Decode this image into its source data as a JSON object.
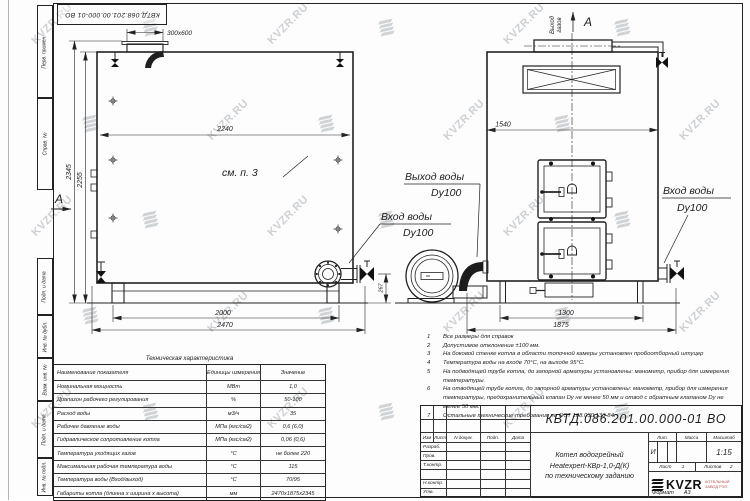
{
  "doc": {
    "number": "КВТД.086.201.00.000-01 ВО",
    "number_top": "КВТД.068.201.00.000-01 ВО",
    "format_label": "Формат",
    "format_value": "А3"
  },
  "watermark": {
    "text": "KVZR.RU"
  },
  "frame_stamps": {
    "top": [
      "Перв. примен.",
      "Справ. №"
    ],
    "bottom": [
      "Подп. и дата",
      "Инв. № дубл.",
      "Взам. инв. №",
      "Подп. и дата",
      "Инв. № подл."
    ]
  },
  "views": {
    "side": {
      "hatch_label": "300x600",
      "width_dim": "2240",
      "height_dim": "2345",
      "height_dim2": "2255",
      "see_note": "см. п. 3",
      "section_label": "А",
      "base_dim": "2000",
      "length_dim": "2470",
      "pipe_height_dim": "267"
    },
    "front": {
      "view_label": "А",
      "gas_outlet": [
        "Выход",
        "газов"
      ],
      "width_dim": "1540",
      "base_dim": "1300",
      "overall_dim": "1875"
    },
    "labels": {
      "water_outlet": [
        "Выход воды",
        "Dy100"
      ],
      "water_inlet_left": [
        "Вход воды",
        "Dy100"
      ],
      "water_inlet_right": [
        "Вход воды",
        "Dy100"
      ]
    }
  },
  "notes": [
    {
      "num": "1",
      "text": "Все размеры для справок"
    },
    {
      "num": "2",
      "text": "Допустимое отклонение ±100 мм."
    },
    {
      "num": "3",
      "text": "На боковой стенке котла в области топочной камеры установлен пробоотборный штуцер"
    },
    {
      "num": "4",
      "text": "Температура воды на входе 70°С, на выходе 95°С."
    },
    {
      "num": "5",
      "text": "На подводящей трубе котла, до запорной арматуры установлены: манометр, прибор для измерения температуры."
    },
    {
      "num": "6",
      "text": "На отводящей трубе котла, до запорной арматуры установлены: манометр, прибор для измерения температуры, предохранительный клапан Dy не менее 50 мм и отвод с обратным клапаном Dy не менее 50 мм."
    },
    {
      "num": "7",
      "text": "Остальные технические требования по ОСТ 108.030.133-84."
    }
  ],
  "tech_table": {
    "title": "Техническая характеристика",
    "headers": [
      "Наименование показателя",
      "Единицы измерения",
      "Значение"
    ],
    "rows": [
      [
        "Номинальная мощность",
        "МВт",
        "1,0"
      ],
      [
        "Диапазон рабочего регулирования",
        "%",
        "50-100"
      ],
      [
        "Расход воды",
        "м3/ч",
        "35"
      ],
      [
        "Рабочее давление воды",
        "МПа (кгс/см2)",
        "0,6 (6,0)"
      ],
      [
        "Гидравлическое сопротивление котла",
        "МПа (кгс/см2)",
        "0,06 (0,6)"
      ],
      [
        "Температура уходящих газов",
        "°С",
        "не более 220"
      ],
      [
        "Максимальная рабочая температура воды",
        "°С",
        "115"
      ],
      [
        "Температура воды (Вход/выход)",
        "°С",
        "70/95"
      ],
      [
        "Габариты котла (длинна х ширина х высота)",
        "мм",
        "2470х1875х2345"
      ]
    ]
  },
  "title_block": {
    "change_cols": [
      "Изм",
      "Лист",
      "N докум.",
      "Подп.",
      "Дата"
    ],
    "roles": [
      "Разраб.",
      "Пров.",
      "Т.контр.",
      "",
      "Н.контр.",
      "Утв."
    ],
    "name_lines": [
      "Котел водогрейный",
      "Heatexpert-КВр-1,0-Д(К)",
      "по техническому заданию"
    ],
    "lit_label": "Лит.",
    "mass_label": "Масса",
    "scale_label": "Масштаб",
    "lit_value": "И",
    "scale_value": "1:15",
    "sheet_label": "Лист",
    "sheet_value": "1",
    "sheets_label": "Листов",
    "sheets_value": "2",
    "logo_text": "KVZR",
    "logo_caption": "КОТЕЛЬНЫЙ ЗАВОД РЭП"
  }
}
